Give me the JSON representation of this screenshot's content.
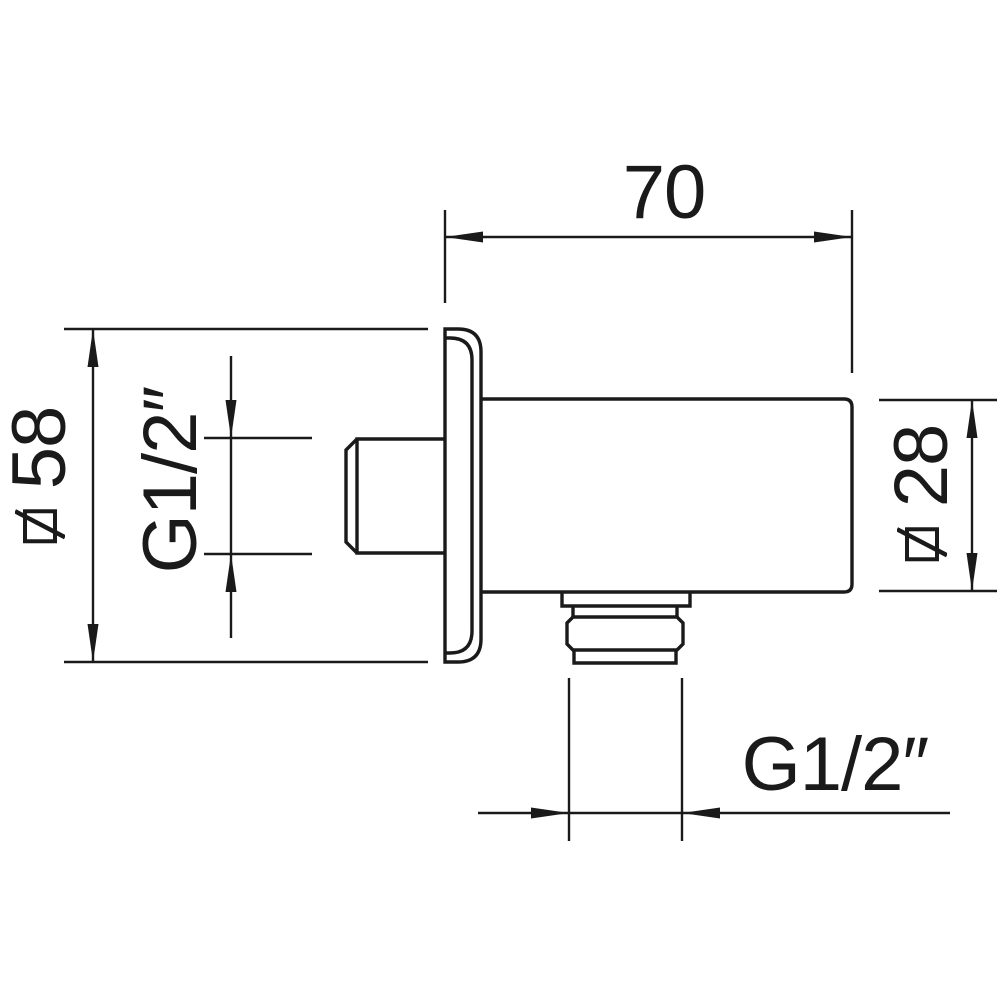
{
  "page": {
    "background": "#ffffff"
  },
  "drawing": {
    "type": "technical-dimension-drawing",
    "subject": "shower wall outlet elbow, side view with square wall plate",
    "line_color": "#1a1a1a",
    "labels": {
      "top_width": "70",
      "plate_size": "58",
      "inlet_thread": "G1/2″",
      "body_depth": "28",
      "outlet_thread": "G1/2″"
    },
    "icons": {
      "plate_size_prefix": "square-diameter-icon",
      "body_depth_prefix": "square-diameter-icon"
    }
  }
}
